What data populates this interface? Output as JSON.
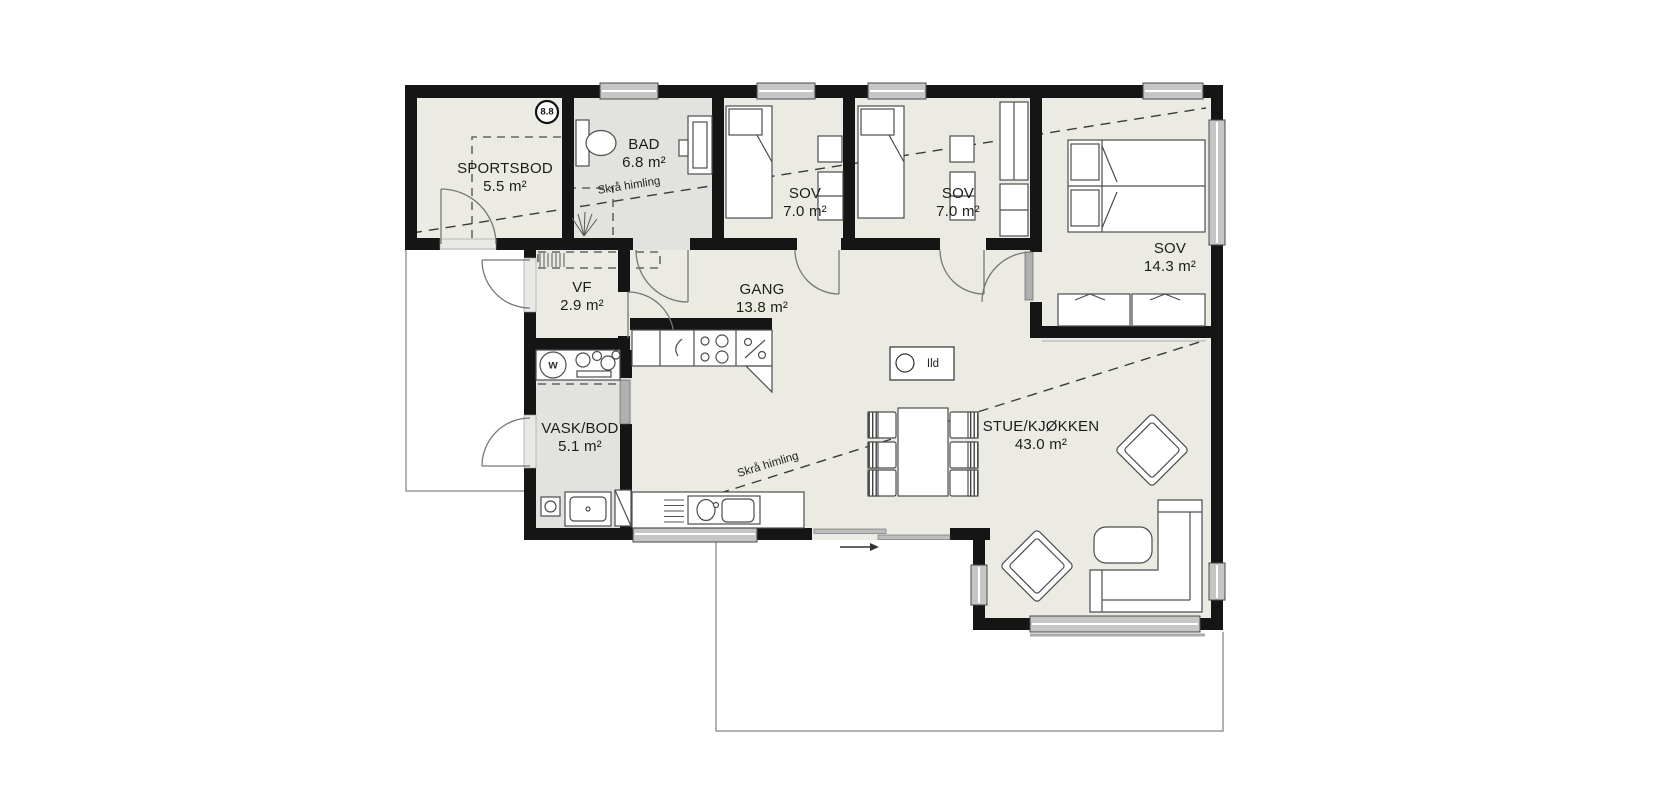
{
  "plan": {
    "rooms": [
      {
        "name": "SPORTSBOD",
        "area": "5.5 m²"
      },
      {
        "name": "BAD",
        "area": "6.8 m²"
      },
      {
        "name": "SOV",
        "area": "7.0 m²"
      },
      {
        "name": "SOV",
        "area": "7.0 m²"
      },
      {
        "name": "SOV",
        "area": "14.3 m²"
      },
      {
        "name": "VF",
        "area": "2.9 m²"
      },
      {
        "name": "GANG",
        "area": "13.8 m²"
      },
      {
        "name": "VASK/BOD",
        "area": "5.1 m²"
      },
      {
        "name": "STUE/KJØKKEN",
        "area": "43.0 m²"
      }
    ],
    "annotations": {
      "sloped_ceiling_upper": "Skrå himling",
      "sloped_ceiling_lower": "Skrå himling",
      "fireplace_label": "Ild",
      "dimension_badge": "8.8",
      "washing_machine_label": "w"
    },
    "colors": {
      "wall": "#151515",
      "floor": "#ECEBE3",
      "wet_room_floor": "#E2E2DF",
      "window_fill": "#C6C6C6",
      "outline_gray": "#999999"
    }
  }
}
